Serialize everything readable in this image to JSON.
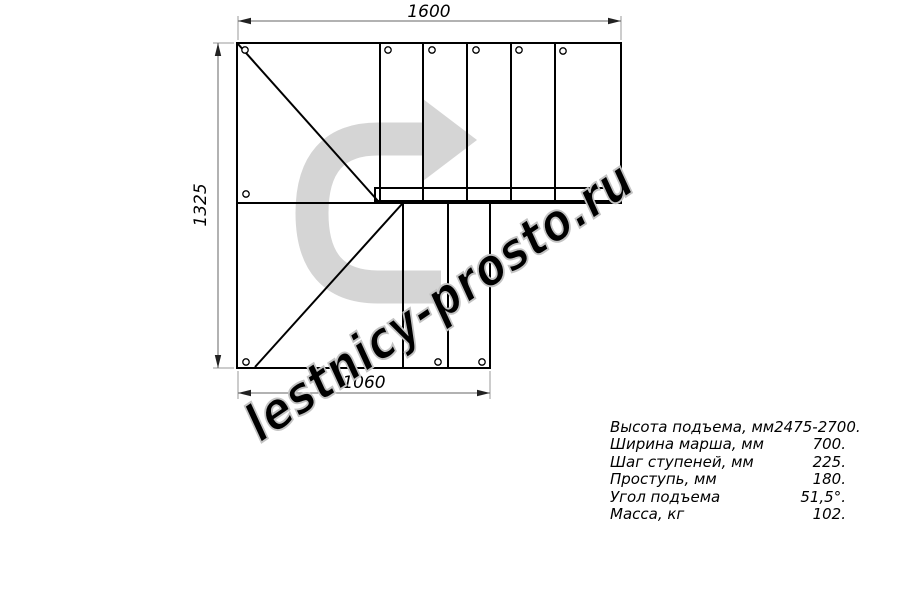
{
  "watermark": {
    "text": "lestnicy-prosto.ru",
    "color": "#c3c3c3"
  },
  "direction_arrow": {
    "name": "u-turn-arrow",
    "color": "#d5d5d5"
  },
  "drawing": {
    "dimensions": {
      "top": "1600",
      "left": "1325",
      "bottom": "1060"
    }
  },
  "specs": {
    "rows": [
      {
        "label": "Высота подъема, мм",
        "value": "2475-2700."
      },
      {
        "label": "Ширина марша, мм",
        "value": "700."
      },
      {
        "label": "Шаг ступеней, мм",
        "value": "225."
      },
      {
        "label": "Проступь, мм",
        "value": "180."
      },
      {
        "label": "Угол подъема",
        "value": "51,5°."
      },
      {
        "label": "Масса, кг",
        "value": "102."
      }
    ]
  }
}
